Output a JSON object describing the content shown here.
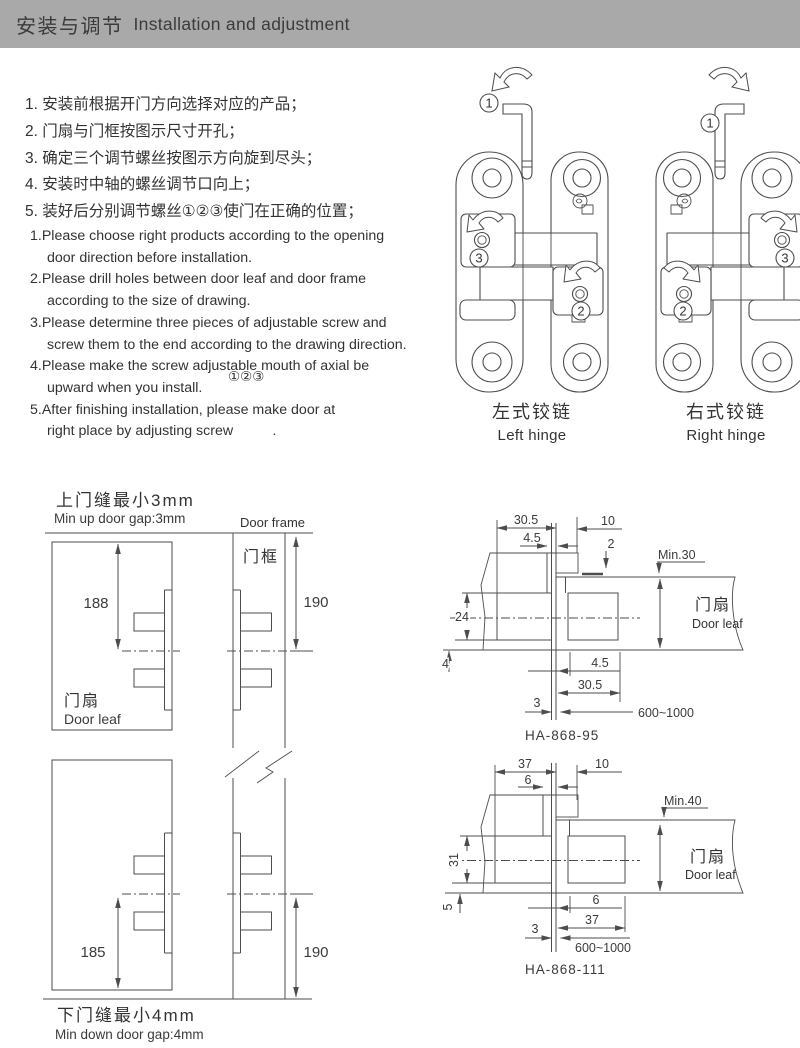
{
  "header": {
    "title_cn": "安装与调节",
    "title_en": "Installation and adjustment"
  },
  "steps_cn": [
    "1. 安装前根据开门方向选择对应的产品；",
    "2. 门扇与门框按图示尺寸开孔；",
    "3. 确定三个调节螺丝按图示方向旋到尽头；",
    "4. 安装时中轴的螺丝调节口向上；",
    "5. 装好后分别调节螺丝①②③使门在正确的位置；"
  ],
  "steps_en": {
    "lines": [
      "1.Please choose right products according to the opening",
      "door direction before installation.",
      "2.Please drill holes between door leaf and door frame",
      "according  to the size of drawing.",
      "3.Please determine three pieces of adjustable screw and",
      "screw them to the end according to the drawing direction.",
      "4.Please make the screw adjustable mouth of axial be",
      "upward when you install.",
      "5.After finishing installation, please make door at",
      "right place by adjusting screw          ."
    ],
    "floating_marks": "①②③"
  },
  "hinges": {
    "screw_1": "1",
    "screw_2": "2",
    "screw_3": "3",
    "left": {
      "label_cn": "左式铰链",
      "label_en": "Left hinge"
    },
    "right": {
      "label_cn": "右式铰链",
      "label_en": "Right hinge"
    }
  },
  "gap_diagram": {
    "title_cn": "上门缝最小3mm",
    "title_en": "Min up door gap:3mm",
    "frame_en": "Door frame",
    "frame_cn": "门框",
    "leaf_cn": "门扇",
    "leaf_en": "Door leaf",
    "dim_leaf_top": "188",
    "dim_frame_top": "190",
    "dim_leaf_bottom": "185",
    "dim_frame_bottom": "190",
    "footer_cn": "下门缝最小4mm",
    "footer_en": "Min down door gap:4mm"
  },
  "model_95": {
    "name": "HA-868-95",
    "leaf_cn": "门扇",
    "leaf_en": "Door leaf",
    "min_note": "Min.30",
    "depth_top": "30.5",
    "slot_top": "4.5",
    "edge_top": "10",
    "offset": "2",
    "body_height": "24",
    "wall": "4",
    "slot_bottom": "4.5",
    "depth_bottom": "30.5",
    "gap": "3",
    "door_width": "600~1000"
  },
  "model_111": {
    "name": "HA-868-111",
    "leaf_cn": "门扇",
    "leaf_en": "Door leaf",
    "min_note": "Min.40",
    "depth_top": "37",
    "slot_top": "6",
    "edge_top": "10",
    "body_height": "31",
    "wall": "5",
    "slot_bottom": "6",
    "depth_bottom": "37",
    "gap": "3",
    "door_width": "600~1000"
  },
  "colors": {
    "header_bg": "#a9a9a9",
    "ink": "#333333",
    "line": "#4d4d4d"
  }
}
